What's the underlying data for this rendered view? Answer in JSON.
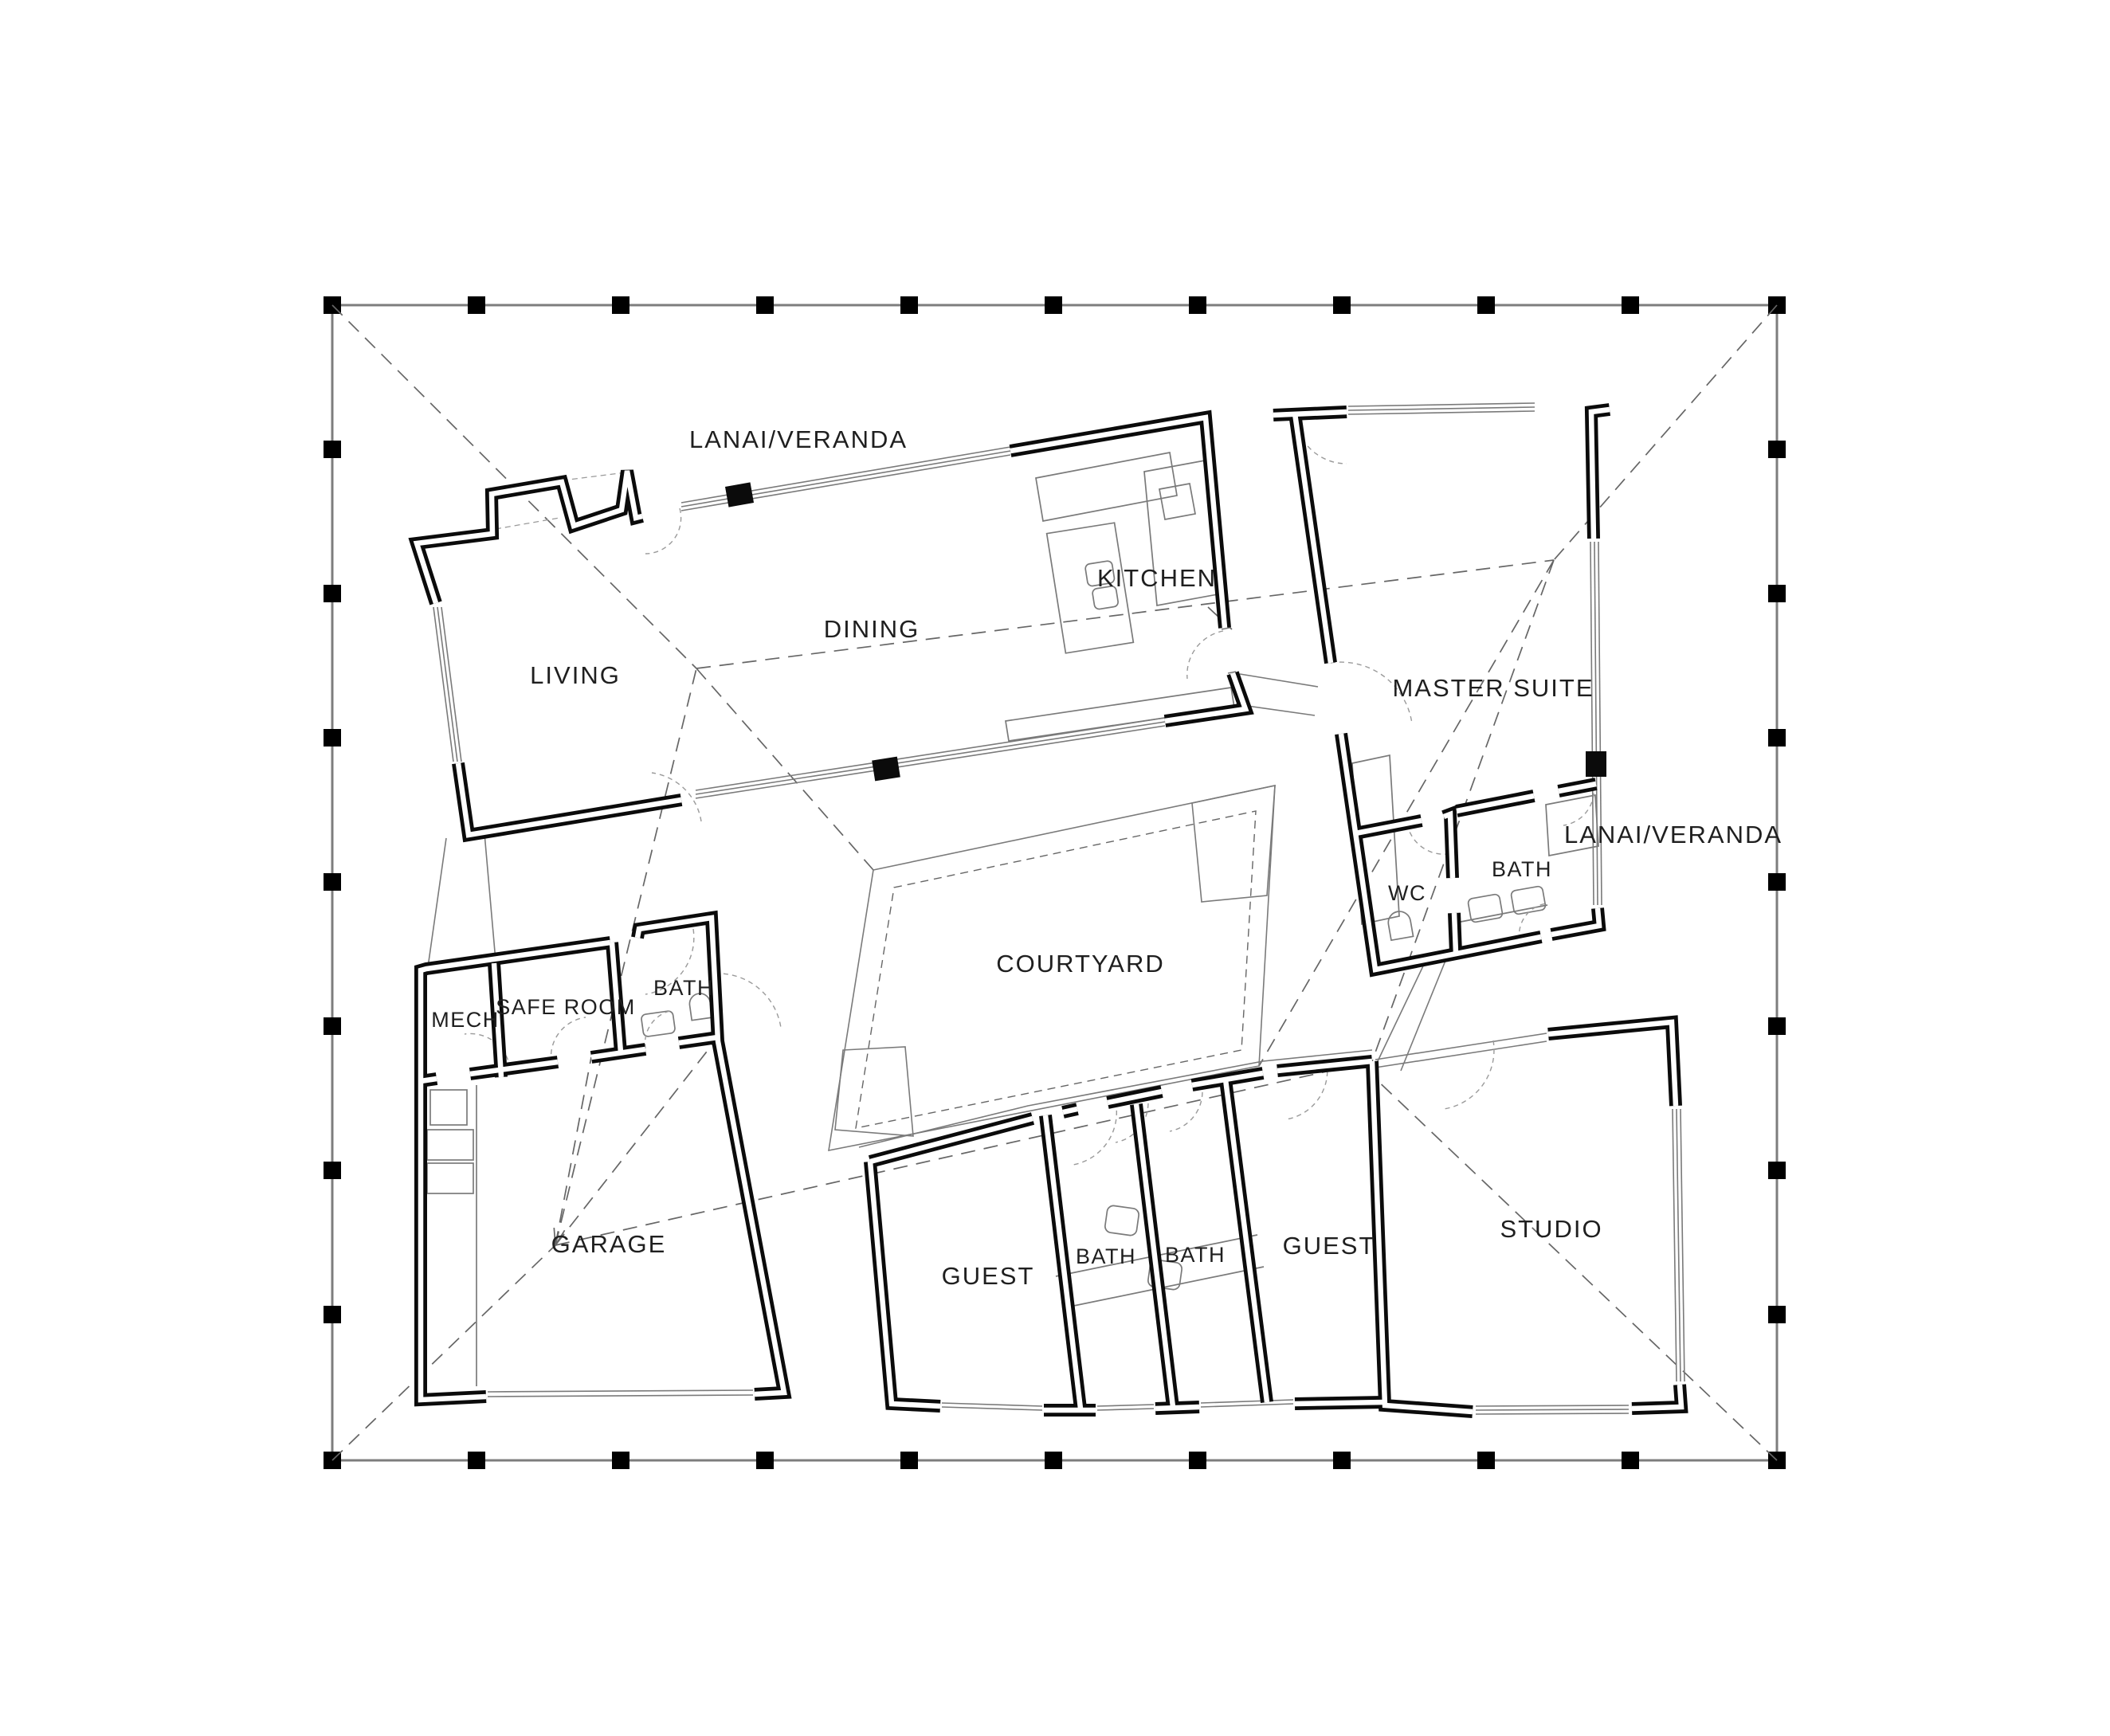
{
  "labels": {
    "lanai_top": "LANAI/VERANDA",
    "living": "LIVING",
    "dining": "DINING",
    "kitchen": "KITCHEN",
    "master_suite": "MASTER SUITE",
    "lanai_right": "LANAI/VERANDA",
    "wc": "WC",
    "bath_master": "BATH",
    "courtyard": "COURTYARD",
    "mech": "MECH",
    "safe_room": "SAFE ROOM",
    "bath_garage": "BATH",
    "garage": "GARAGE",
    "guest_west": "GUEST",
    "bath_guest_west": "BATH",
    "bath_guest_east": "BATH",
    "guest_east": "GUEST",
    "studio": "STUDIO"
  },
  "colors": {
    "wall": "#0b0b0b",
    "wall-core": "#ffffff",
    "thin": "#7a7a7a",
    "boundary": "#7d7d7d",
    "dashed": "#666666",
    "door-arc": "#9a9a9a",
    "text": "#1f1f1f",
    "bg": "#ffffff"
  }
}
